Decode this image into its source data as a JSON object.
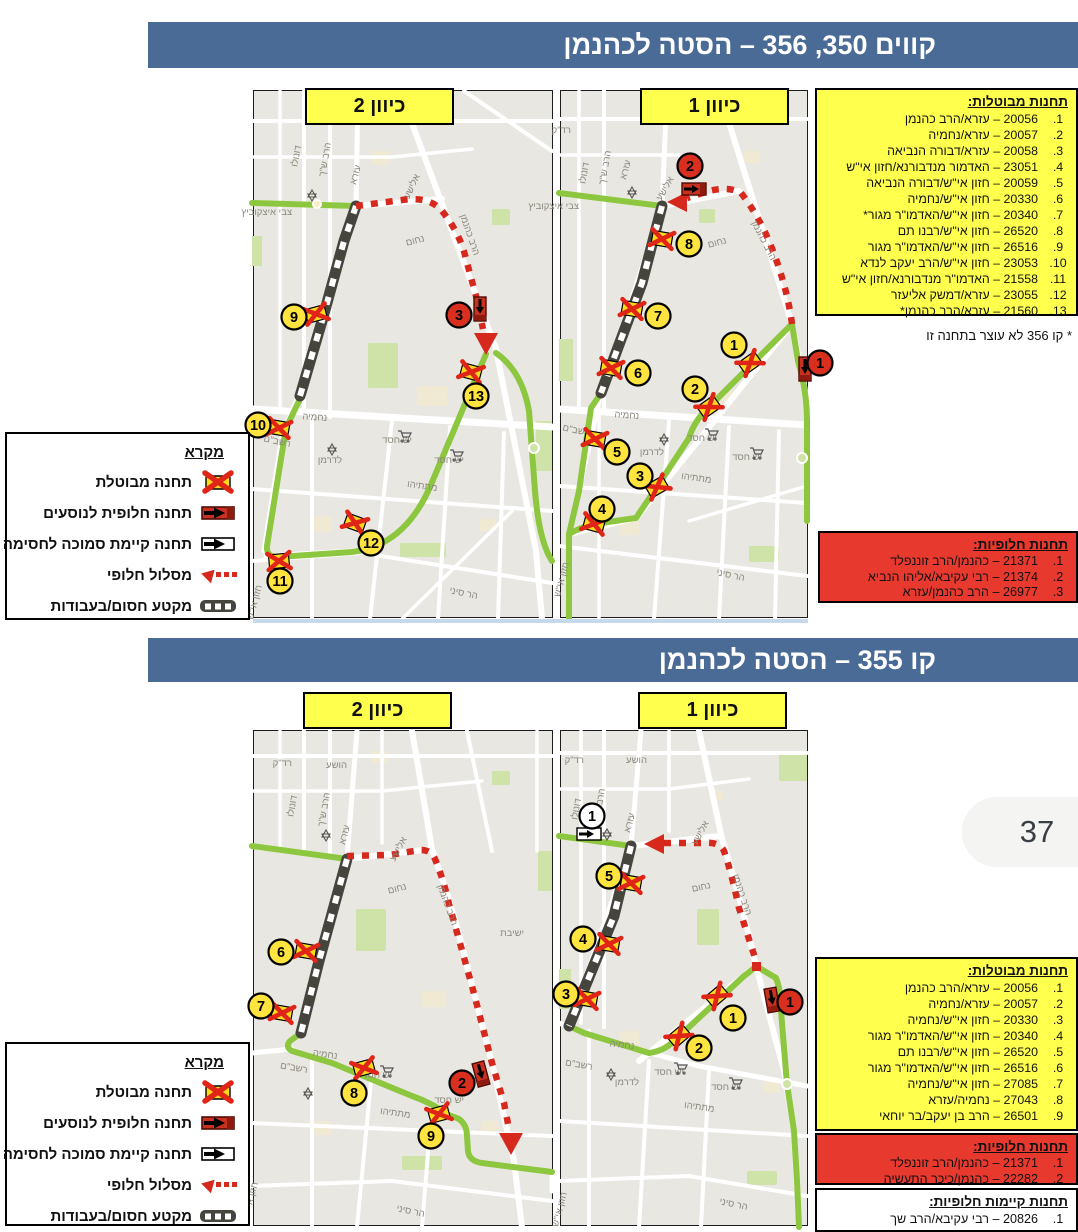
{
  "page_number": "37",
  "colors": {
    "header_blue": "#4a6b96",
    "box_yellow": "#ffff4e",
    "box_red": "#e8392e",
    "route_green": "#8dc63f",
    "route_red": "#d7281d",
    "marker_yellow": "#ffe33e"
  },
  "legend": {
    "title": "מקרא",
    "items": [
      "תחנה מבוטלת",
      "תחנה חלופית לנוסעים",
      "תחנה קיימת סמוכה לחסימה",
      "מסלול חלופי",
      "מקטע חסום/בעבודות"
    ]
  },
  "streets": {
    "shach": "הרב ש\"ך",
    "donolo": "דונולו",
    "ezra": "עזרא",
    "elisha": "אלישע",
    "nachum": "נחום",
    "kahaneman": "הרב כהנמן",
    "itzkovitz": "צבי איצקוביץ",
    "nehemia": "נחמיה",
    "rashbam": "רשב\"ם",
    "lederman": "לדרמן",
    "yeshchesed": "יש חסד",
    "matityahu": "מתתיהו",
    "harsinai": "הר סיני",
    "chazonish": "חזון אי\"ש",
    "hoshea": "הושע",
    "radak": "רד\"ק",
    "yeshiva": "ישיבת"
  },
  "section1": {
    "title": "קווים 350, 356 – הסטה לכהנמן",
    "dir1": "כיוון 1",
    "dir2": "כיוון 2",
    "cancelled": {
      "title": "תחנות מבוטלות:",
      "items": [
        {
          "n": "1.",
          "text": "20056 – עזרא/הרב כהנמן"
        },
        {
          "n": "2.",
          "text": "20057 – עזרא/נחמיה"
        },
        {
          "n": "3.",
          "text": "20058 – עזרא/דבורה הנביאה"
        },
        {
          "n": "4.",
          "text": "23051 – האדמור מנדבורנא/חזון אי\"ש"
        },
        {
          "n": "5.",
          "text": "20059 – חזון אי\"ש/דבורה הנביאה"
        },
        {
          "n": "6.",
          "text": "20330 – חזון אי\"ש/נחמיה"
        },
        {
          "n": "7.",
          "text": "20340 – חזון אי\"ש/האדמו\"ר מגור*"
        },
        {
          "n": "8.",
          "text": "26520 – חזון אי\"ש/רבנו תם"
        },
        {
          "n": "9.",
          "text": "26516 – חזון אי\"ש/האדמו\"ר מגור"
        },
        {
          "n": "10.",
          "text": "23053 – חזון אי\"ש/הרב יעקב לנדא"
        },
        {
          "n": "11.",
          "text": "21558 – האדמו\"ר מנדבורנא/חזון אי\"ש"
        },
        {
          "n": "12.",
          "text": "23055 – עזרא/דמשק אליעזר"
        },
        {
          "n": "13.",
          "text": "21560 – עזרא/הרב כהנמן*"
        }
      ]
    },
    "note": "* קו 356 לא עוצר בתחנה זו",
    "alternative": {
      "title": "תחנות חלופיות:",
      "items": [
        {
          "n": "1.",
          "text": "21371 – כהנמן/הרב זוננפלד"
        },
        {
          "n": "2.",
          "text": "21374 – רבי עקיבא/אליהו הנביא"
        },
        {
          "n": "3.",
          "text": "26977 – הרב כהנמן/עזרא"
        }
      ]
    }
  },
  "section2": {
    "title": "קו 355 – הסטה לכהנמן",
    "dir1": "כיוון 1",
    "dir2": "כיוון 2",
    "cancelled": {
      "title": "תחנות מבוטלות:",
      "items": [
        {
          "n": "1.",
          "text": "20056 – עזרא/הרב כהנמן"
        },
        {
          "n": "2.",
          "text": "20057 – עזרא/נחמיה"
        },
        {
          "n": "3.",
          "text": "20330 – חזון אי\"ש/נחמיה"
        },
        {
          "n": "4.",
          "text": "20340 – חזון אי\"ש/האדמו\"ר מגור"
        },
        {
          "n": "5.",
          "text": "26520 – חזון אי\"ש/רבנו תם"
        },
        {
          "n": "6.",
          "text": "26516 – חזון אי\"ש/האדמו\"ר מגור"
        },
        {
          "n": "7.",
          "text": "27085 – חזון אי\"ש/נחמיה"
        },
        {
          "n": "8.",
          "text": "27043 – נחמיה/עזרא"
        },
        {
          "n": "9.",
          "text": "26501 – הרב בן יעקב/בר יוחאי"
        }
      ]
    },
    "alternative": {
      "title": "תחנות חלופיות:",
      "items": [
        {
          "n": "1.",
          "text": "21371 – כהנמן/הרב זוננפלד"
        },
        {
          "n": "2.",
          "text": "22282 – כהנמן/כיכר התעשיה"
        }
      ]
    },
    "existing": {
      "title": "תחנות קיימות חלופיות:",
      "items": [
        {
          "n": "1.",
          "text": "20826 – רבי עקיבא/הרב שך"
        }
      ]
    }
  },
  "maps": {
    "t2": {
      "markers": {
        "m9": "9",
        "m10": "10",
        "m11": "11",
        "m12": "12",
        "m13": "13",
        "alt": "3"
      }
    },
    "t1": {
      "markers": {
        "m1": "1",
        "m2": "2",
        "m3": "3",
        "m4": "4",
        "m5": "5",
        "m6": "6",
        "m7": "7",
        "m8": "8",
        "altA": "1",
        "altB": "2"
      }
    },
    "b2": {
      "markers": {
        "m6": "6",
        "m7": "7",
        "m8": "8",
        "m9": "9",
        "alt": "2"
      }
    },
    "b1": {
      "markers": {
        "m1": "1",
        "m2": "2",
        "m3": "3",
        "m4": "4",
        "m5": "5",
        "alt": "1",
        "exist": "1"
      }
    }
  }
}
